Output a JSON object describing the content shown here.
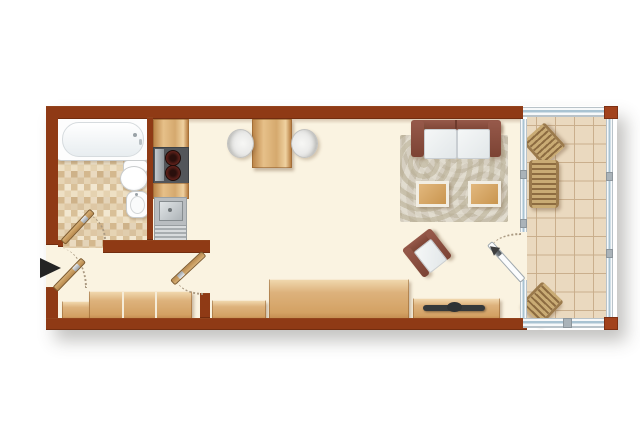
{
  "title": "studio-apartment-floor-plan",
  "palette": {
    "background": "#ffffff",
    "wall": "#8f3a15",
    "wall_post": "#a2421c",
    "floor": "#faf3e1",
    "bath_tile": "#e7d5b6",
    "balcony_tile": "#ead9bf",
    "wood": "#d9a96b",
    "upholstery_frame": "#84493a",
    "cushion": "#eef0f1",
    "rug_base": "#d6cfc1",
    "rug_swirl": "#c2b9a4",
    "fixture_white": "#fbfbfb",
    "steel": "#b9bdc0",
    "tv": "#35393b",
    "glass_line": "#a9c3d2",
    "door_leaf_wood": "#c59a5e",
    "door_leaf_glass": "#fbfcfd",
    "swing_arc": "#ab9a82",
    "entry_arrow": "#242424"
  },
  "rooms": [
    {
      "name": "bathroom",
      "floor": "mosaic-tile",
      "fixtures": [
        "bathtub",
        "toilet",
        "bidet",
        "swing-door"
      ]
    },
    {
      "name": "kitchenette",
      "fixtures": [
        "counter",
        "cooktop-two-burners",
        "sink",
        "drainer"
      ]
    },
    {
      "name": "hallway",
      "fixtures": [
        "entry-door",
        "wardrobe-small",
        "wardrobe-three-sections"
      ]
    },
    {
      "name": "living-room",
      "furniture": [
        "dining-table",
        "dining-chair-left",
        "dining-chair-right",
        "two-seat-sofa",
        "swirl-rug",
        "side-table-left",
        "side-table-right",
        "armchair",
        "sideboard",
        "chest",
        "tv-lowboard",
        "tv",
        "interior-door",
        "balcony-glass-door"
      ]
    },
    {
      "name": "balcony",
      "floor": "large-tile",
      "enclosure": "glazed",
      "furniture": [
        "deck-chair-top",
        "sun-lounger",
        "deck-chair-bottom"
      ]
    }
  ],
  "markers": {
    "entrance_arrow": "right-pointing-triangle"
  }
}
